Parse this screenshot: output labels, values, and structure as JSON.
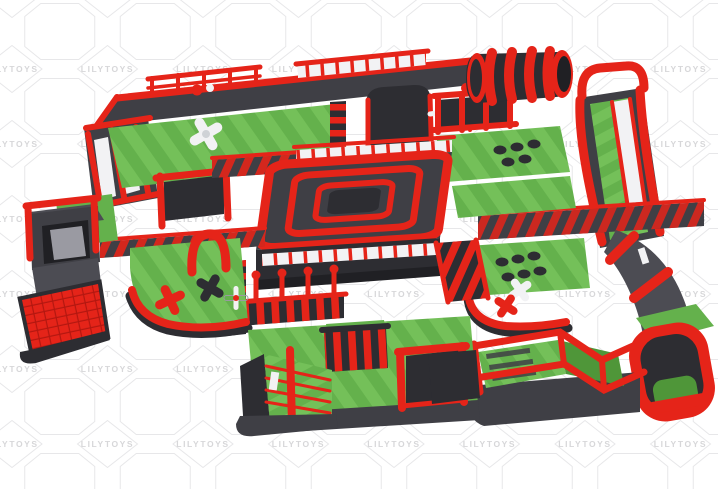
{
  "image": {
    "subject": "Inflatable obstacle course park - 3D render",
    "background": "#ffffff"
  },
  "watermark": {
    "text": "LILYTOYS",
    "text_color": "#d7d7d9",
    "line_color": "#e7e7e9",
    "grid": {
      "columns_x": [
        12,
        107.5,
        203,
        298.5,
        394,
        489.5,
        585,
        680.5
      ],
      "rows_y": [
        69,
        144,
        219,
        294,
        369,
        444
      ]
    }
  },
  "palette": {
    "red": "#e52419",
    "red_dark": "#b31710",
    "dark": "#3f3f45",
    "dark_mid": "#4c4c53",
    "dark_deep": "#2d2d32",
    "ink": "#202024",
    "green": "#64b14c",
    "green_light": "#74c059",
    "green_dark": "#4f9639",
    "white_panel": "#f2f2f4",
    "gray_slide": "#9a9aa2"
  }
}
